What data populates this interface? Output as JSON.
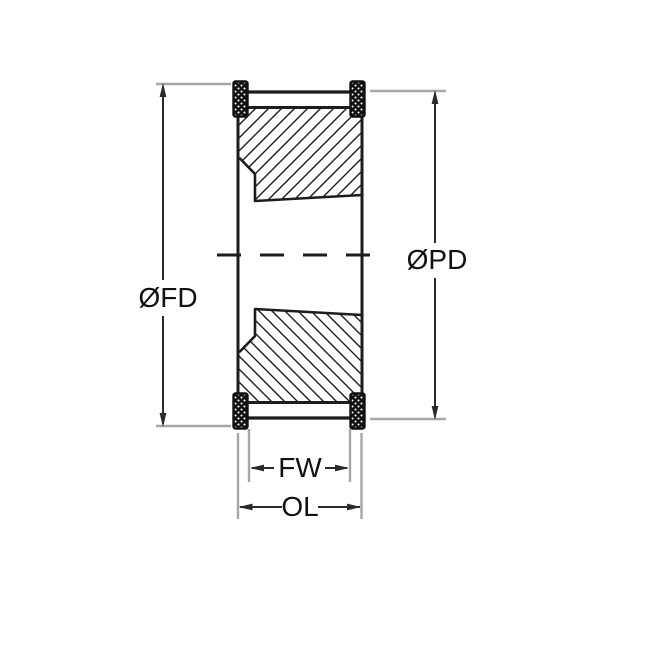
{
  "drawing": {
    "type": "technical-cross-section",
    "subject": "timing-belt pulley with taper bore and flanges",
    "labels": {
      "flange_diameter": "ØFD",
      "pitch_diameter": "ØPD",
      "face_width": "FW",
      "overall_length": "OL"
    },
    "colors": {
      "part_line": "#1c1c1c",
      "dimension_line": "#2a2a2a",
      "extension_line": "#a6a6a6",
      "background": "#ffffff",
      "label_text": "#111111"
    }
  }
}
